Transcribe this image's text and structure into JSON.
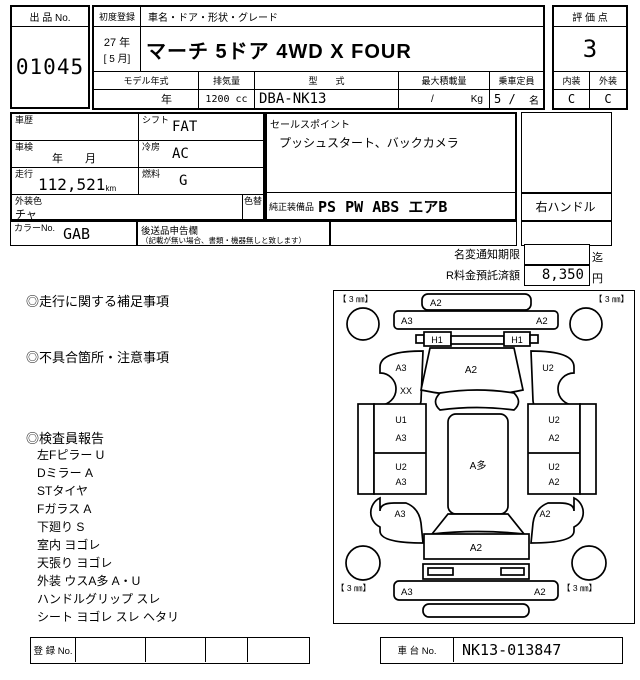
{
  "top": {
    "auction_no_label": "出 品 No.",
    "auction_no": "01045",
    "first_reg_label": "初度登録",
    "first_reg_year": "27 年",
    "first_reg_month": "[ 5 月]",
    "car_name_label": "車名・ドア・形状・グレード",
    "car_name": "マーチ 5ドア 4WD X FOUR",
    "model_year_label": "モデル年式",
    "model_year_value": "年",
    "displacement_label": "排気量",
    "displacement_value": "1200 cc",
    "model_code_label": "型　　式",
    "model_code_value": "DBA-NK13",
    "max_load_label": "最大積載量",
    "max_load_slash": "/",
    "max_load_unit": "Kg",
    "capacity_label": "乗車定員",
    "capacity_value": "5 /",
    "capacity_unit": "名",
    "score_label": "評 価 点",
    "score_value": "3",
    "interior_label": "内装",
    "exterior_label": "外装",
    "interior_value": "C",
    "exterior_value": "C"
  },
  "details": {
    "history_label": "車歴",
    "shift_label": "シフト",
    "shift_value": "FAT",
    "inspection_label": "車検",
    "inspection_value": "年　　月",
    "ac_label": "冷房",
    "ac_value": "AC",
    "mileage_label": "走行",
    "mileage_value": "112,521",
    "mileage_unit": "km",
    "fuel_label": "燃料",
    "fuel_value": "G",
    "color_label": "外装色",
    "color_value": "チャ",
    "recolor_label": "色替",
    "color_no_label": "カラーNo.",
    "color_no_value": "GAB",
    "later_label": "後送品申告欄",
    "later_note": "（記載が無い場合、書類・機器無しと致します）",
    "sales_label": "セールスポイント",
    "sales_value": "プッシュスタート、バックカメラ",
    "equip_label": "純正装備品",
    "equip_value": "PS PW ABS エアB",
    "handle_value": "右ハンドル",
    "rename_label": "名変通知期限",
    "rename_suffix": "迄",
    "recycle_label": "R料金預託済額",
    "recycle_value": "8,350",
    "recycle_suffix": "円"
  },
  "notes": {
    "supplement_title": "◎走行に関する補足事項",
    "defect_title": "◎不具合箇所・注意事項",
    "inspector_title": "◎検査員報告",
    "inspector_items": [
      "左Fピラー U",
      "Dミラー A",
      "STタイヤ",
      "Fガラス A",
      "下廻り S",
      "室内 ヨゴレ",
      "天張り ヨゴレ",
      "外装 ウスA多 A・U",
      "ハンドルグリップ スレ",
      "シート ヨゴレ スレ ヘタリ"
    ]
  },
  "diagram": {
    "corner_tl": "【 3 ㎜】",
    "corner_tr": "【 3 ㎜】",
    "corner_bl": "【 3 ㎜】",
    "corner_br": "【 3 ㎜】",
    "front_bumper": "A2",
    "front_face_left": "A3",
    "front_face_right": "A2",
    "headlamp_left": "H1",
    "headlamp_right": "H1",
    "fender_fl_a": "A3",
    "fender_fl_b": "XX",
    "hood": "A2",
    "fender_fr": "U2",
    "door_fl_a": "U1",
    "door_fl_b": "A3",
    "door_rl_a": "U2",
    "door_rl_b": "A3",
    "roof": "A多",
    "door_fr_a": "U2",
    "door_fr_b": "A2",
    "door_rr_a": "U2",
    "door_rr_b": "A2",
    "fender_rl": "A3",
    "fender_rr": "A2",
    "tailgate": "A2",
    "rear_face_left": "A3",
    "rear_face_right": "A2"
  },
  "footer": {
    "reg_label": "登 録 No.",
    "chassis_label": "車 台 No.",
    "chassis_value": "NK13-013847"
  }
}
